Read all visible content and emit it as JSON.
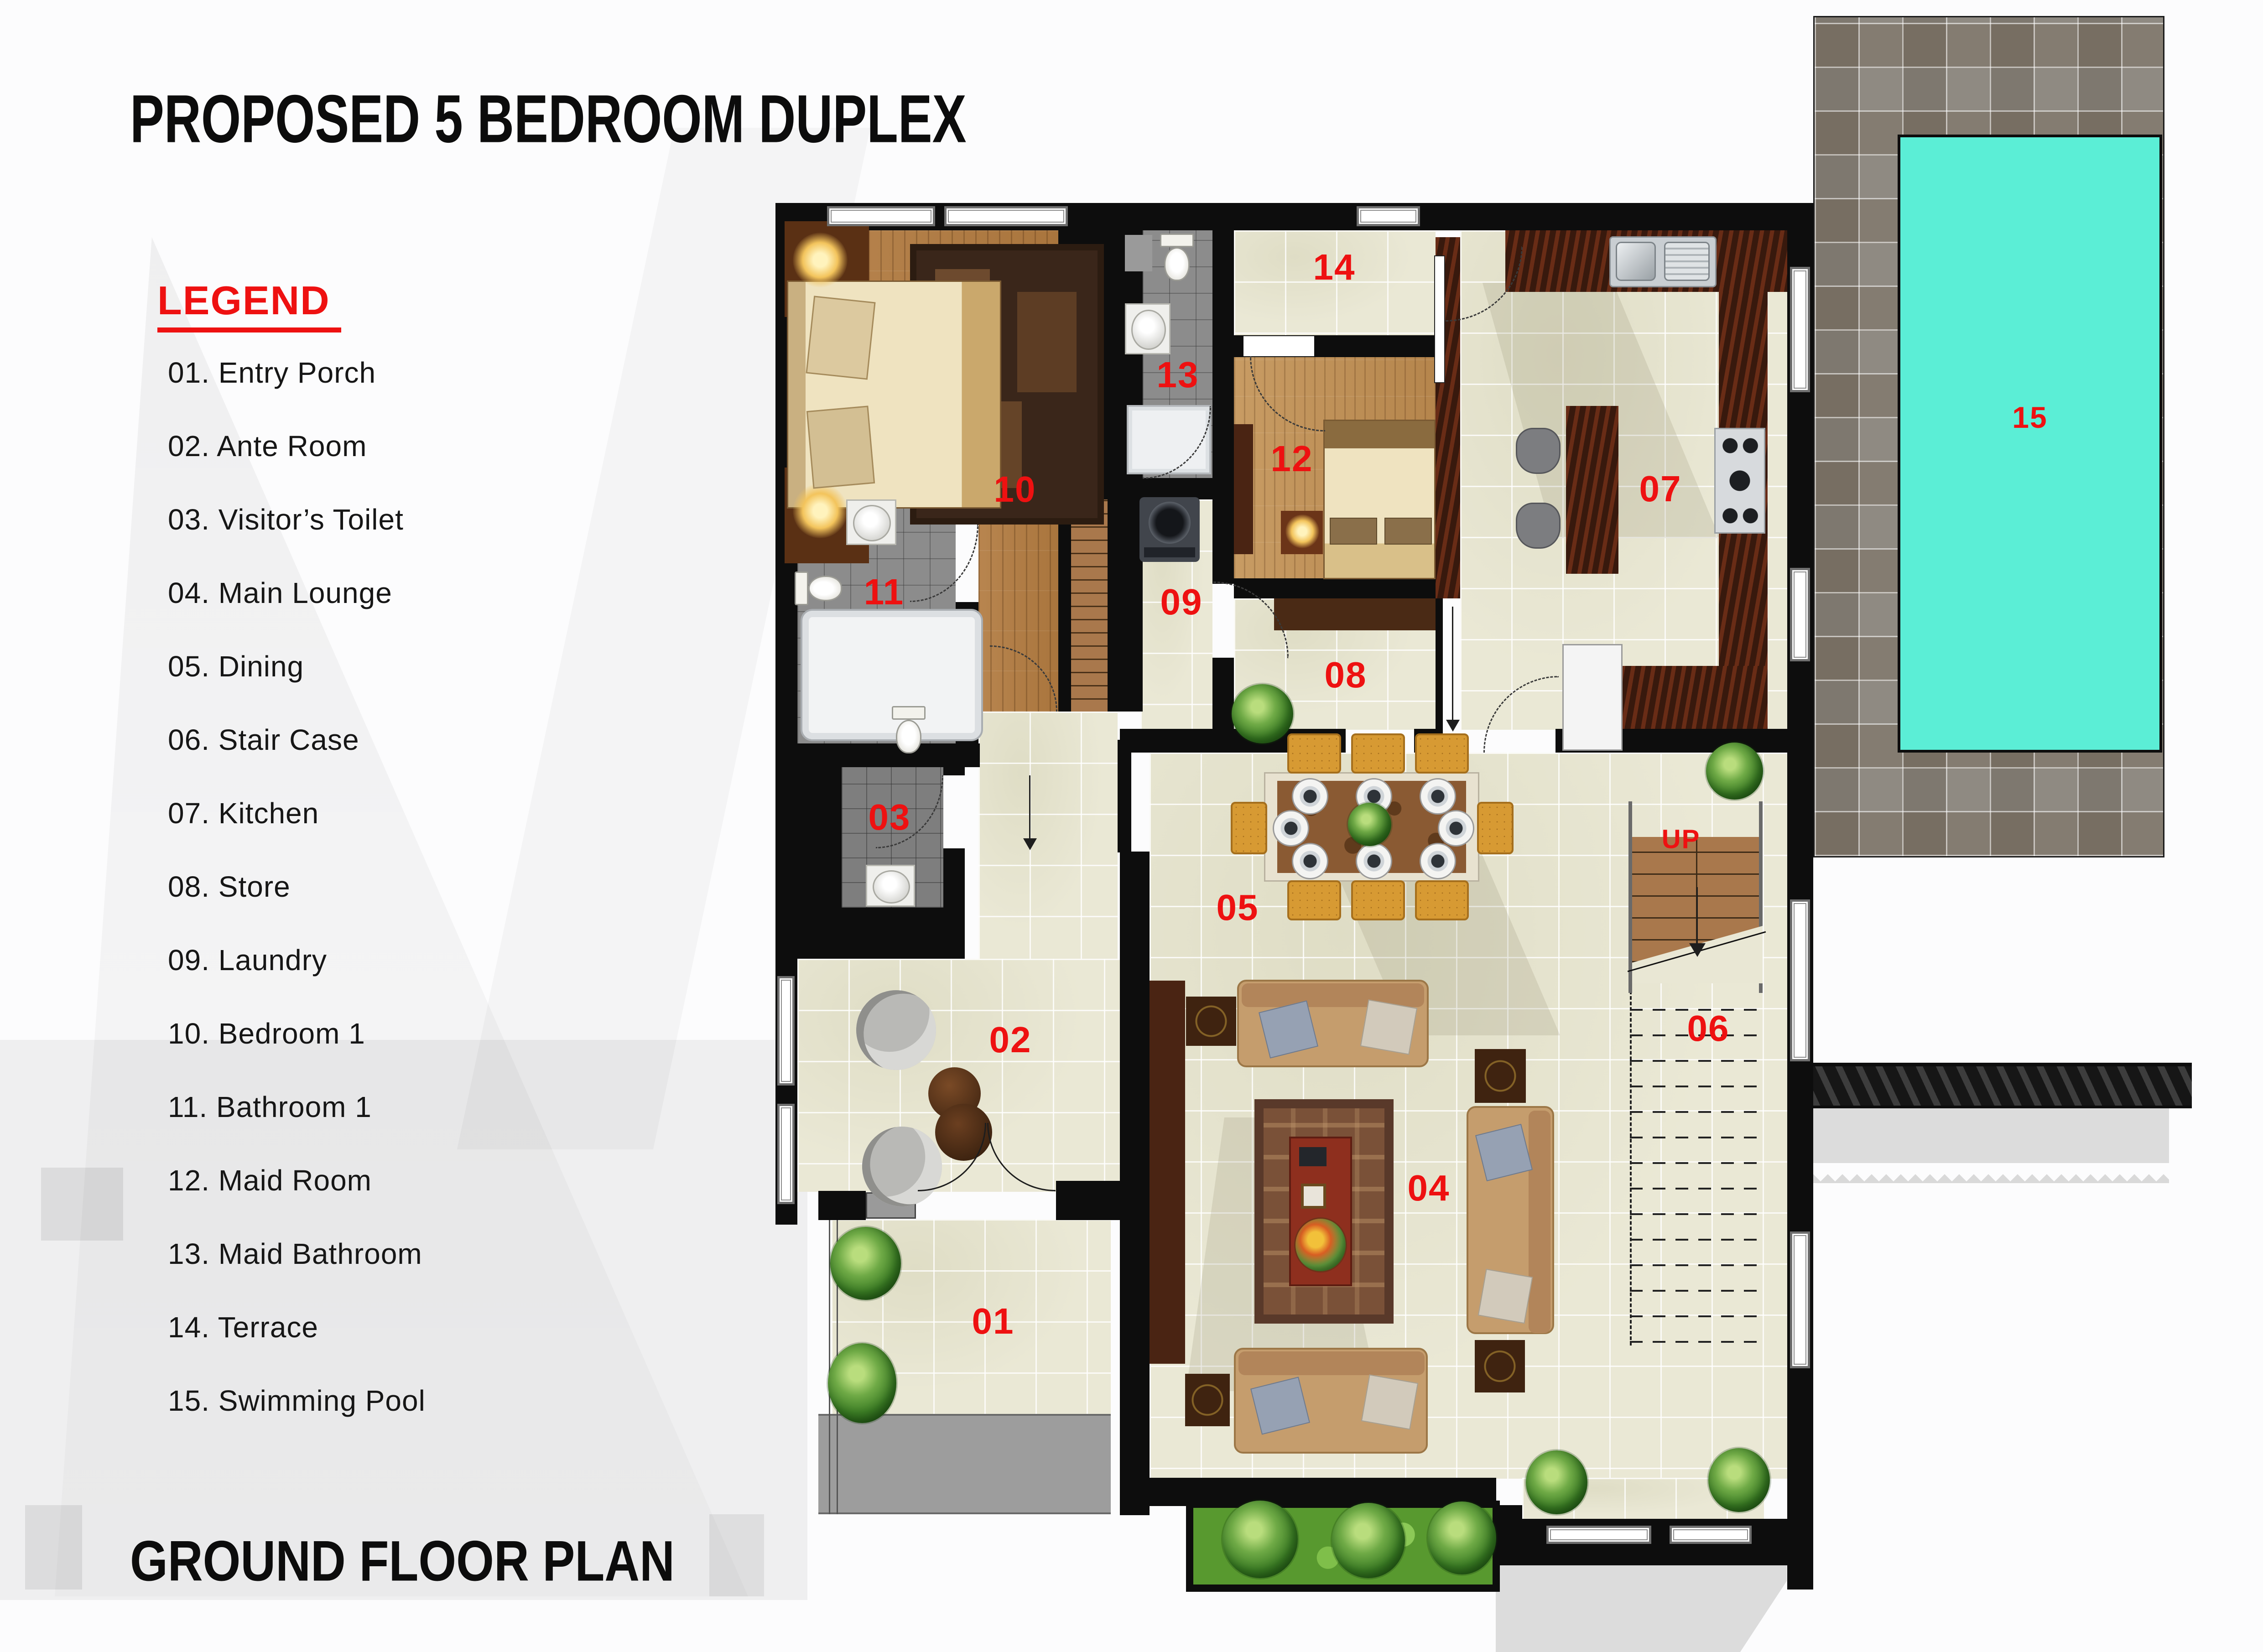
{
  "page": {
    "title": "PROPOSED 5 BEDROOM DUPLEX",
    "footer": "GROUND FLOOR PLAN"
  },
  "legend": {
    "heading": "LEGEND",
    "items": [
      {
        "label": "01. Entry Porch"
      },
      {
        "label": "02. Ante Room"
      },
      {
        "label": "03. Visitor’s Toilet"
      },
      {
        "label": "04. Main Lounge"
      },
      {
        "label": "05. Dining"
      },
      {
        "label": "06. Stair Case"
      },
      {
        "label": "07. Kitchen"
      },
      {
        "label": "08. Store"
      },
      {
        "label": "09. Laundry"
      },
      {
        "label": "10. Bedroom 1"
      },
      {
        "label": "11. Bathroom 1"
      },
      {
        "label": "12. Maid Room"
      },
      {
        "label": "13. Maid Bathroom"
      },
      {
        "label": "14. Terrace"
      },
      {
        "label": "15. Swimming Pool"
      }
    ]
  },
  "plan": {
    "labels": [
      {
        "id": "entry-porch",
        "text": "01"
      },
      {
        "id": "ante-room",
        "text": "02"
      },
      {
        "id": "visitors-toilet",
        "text": "03"
      },
      {
        "id": "main-lounge",
        "text": "04"
      },
      {
        "id": "dining",
        "text": "05"
      },
      {
        "id": "stair-case",
        "text": "06"
      },
      {
        "id": "kitchen",
        "text": "07"
      },
      {
        "id": "store",
        "text": "08"
      },
      {
        "id": "laundry",
        "text": "09"
      },
      {
        "id": "bedroom-1",
        "text": "10"
      },
      {
        "id": "bathroom-1",
        "text": "11"
      },
      {
        "id": "maid-room",
        "text": "12"
      },
      {
        "id": "maid-bathroom",
        "text": "13"
      },
      {
        "id": "terrace",
        "text": "14"
      },
      {
        "id": "swimming-pool",
        "text": "15"
      },
      {
        "id": "stairs-direction",
        "text": "UP"
      }
    ]
  },
  "colors": {
    "accent_red": "#ee1111",
    "pool_water": "#5beed6",
    "wall_black": "#0d0d0d",
    "tile_cream": "#eae8d5",
    "bath_gray": "#8c8c8c",
    "wood_brown": "#b07b45",
    "counter_brown": "#4b2414"
  }
}
